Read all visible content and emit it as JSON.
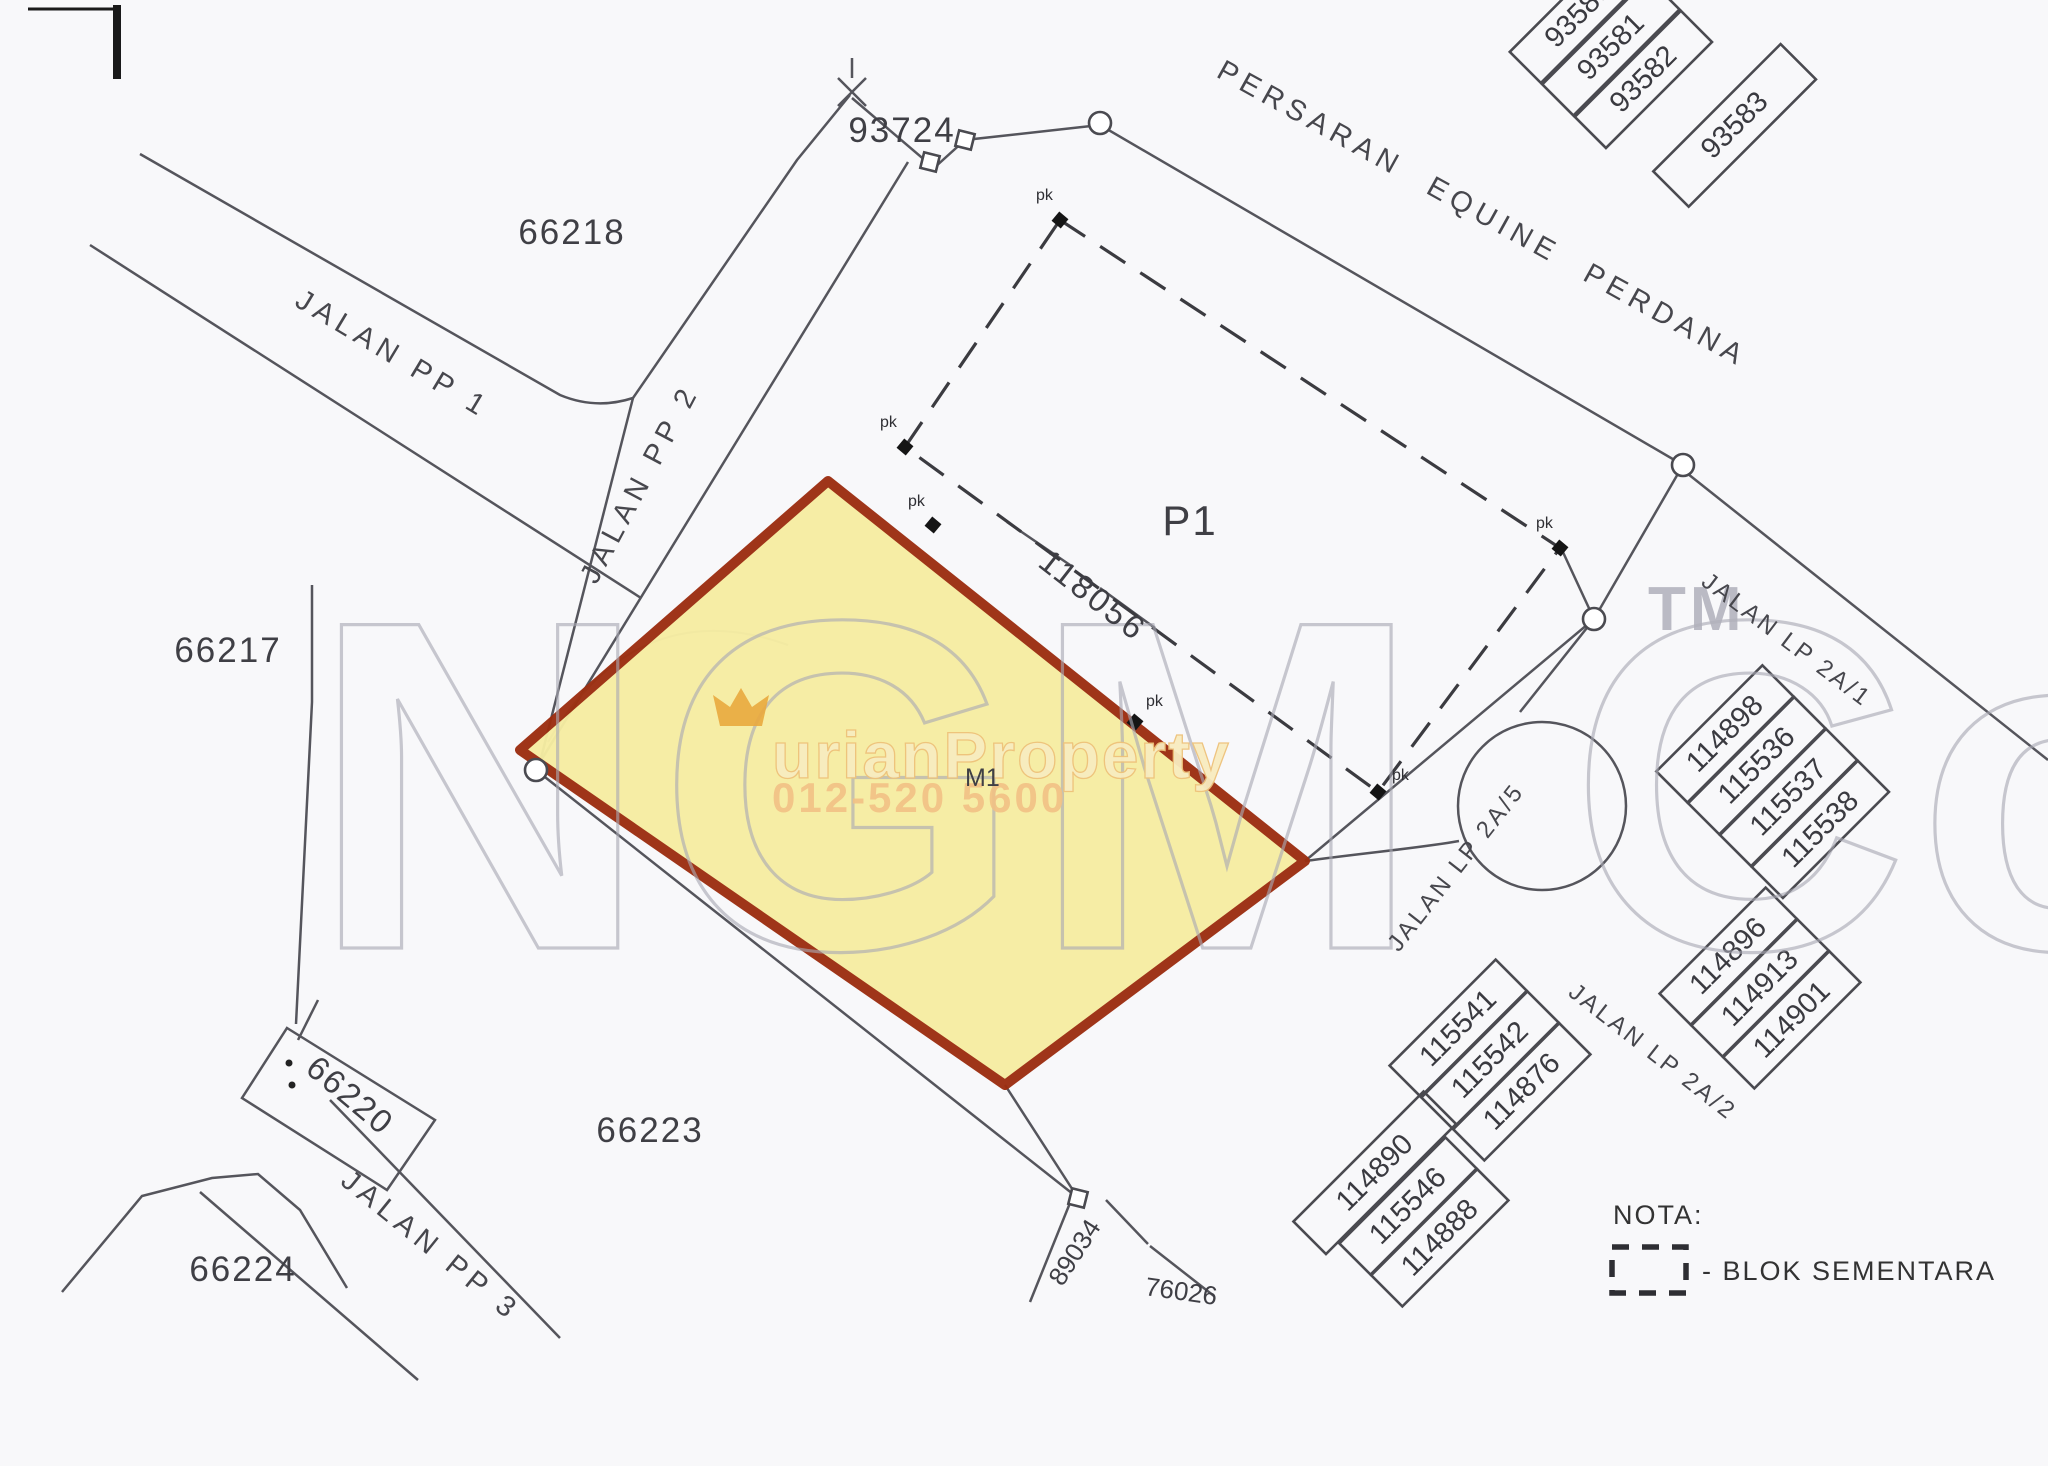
{
  "lots": {
    "l66218": "66218",
    "l66217": "66217",
    "l66223": "66223",
    "l66224": "66224",
    "l66220": "66220",
    "l93724": "93724",
    "p1": "P1",
    "parcel": "M1"
  },
  "roads": {
    "pp1": "JALAN PP 1",
    "pp2": "JALAN PP 2",
    "pp3": "JALAN PP 3",
    "persaran": "PERSARAN EQUINE PERDANA",
    "lp2a1": "JALAN LP 2A/1",
    "lp2a5": "JALAN LP 2A/5",
    "lp2a2": "JALAN LP 2A/2"
  },
  "dimension": "118056",
  "pk_label": "pk",
  "bottom_numbers": {
    "n89034": "89034",
    "n76026": "76026"
  },
  "clusters": {
    "tr": {
      "numbers": [
        "93580",
        "93581",
        "93582",
        "93583"
      ]
    },
    "a": {
      "numbers": [
        "114898",
        "115536",
        "115537",
        "115538"
      ]
    },
    "b": {
      "numbers": [
        "114896",
        "114913",
        "114901"
      ]
    },
    "c": {
      "numbers": [
        "115541",
        "115542",
        "114876"
      ]
    },
    "d": {
      "numbers": [
        "114890",
        "115546",
        "114888"
      ]
    }
  },
  "legend": {
    "title": "NOTA:",
    "dash_meaning": "- BLOK SEMENTARA"
  },
  "watermark": {
    "brand": "NGM Co",
    "trademark": "TM",
    "property": "urianProperty",
    "phone": "012-520 5600"
  },
  "colors": {
    "parcel_fill": "#f6eda2",
    "parcel_border": "#9c2e10",
    "map_line": "#55555c",
    "watermark_grey": "#a9a9b4",
    "watermark_orange": "#e9a93e"
  }
}
